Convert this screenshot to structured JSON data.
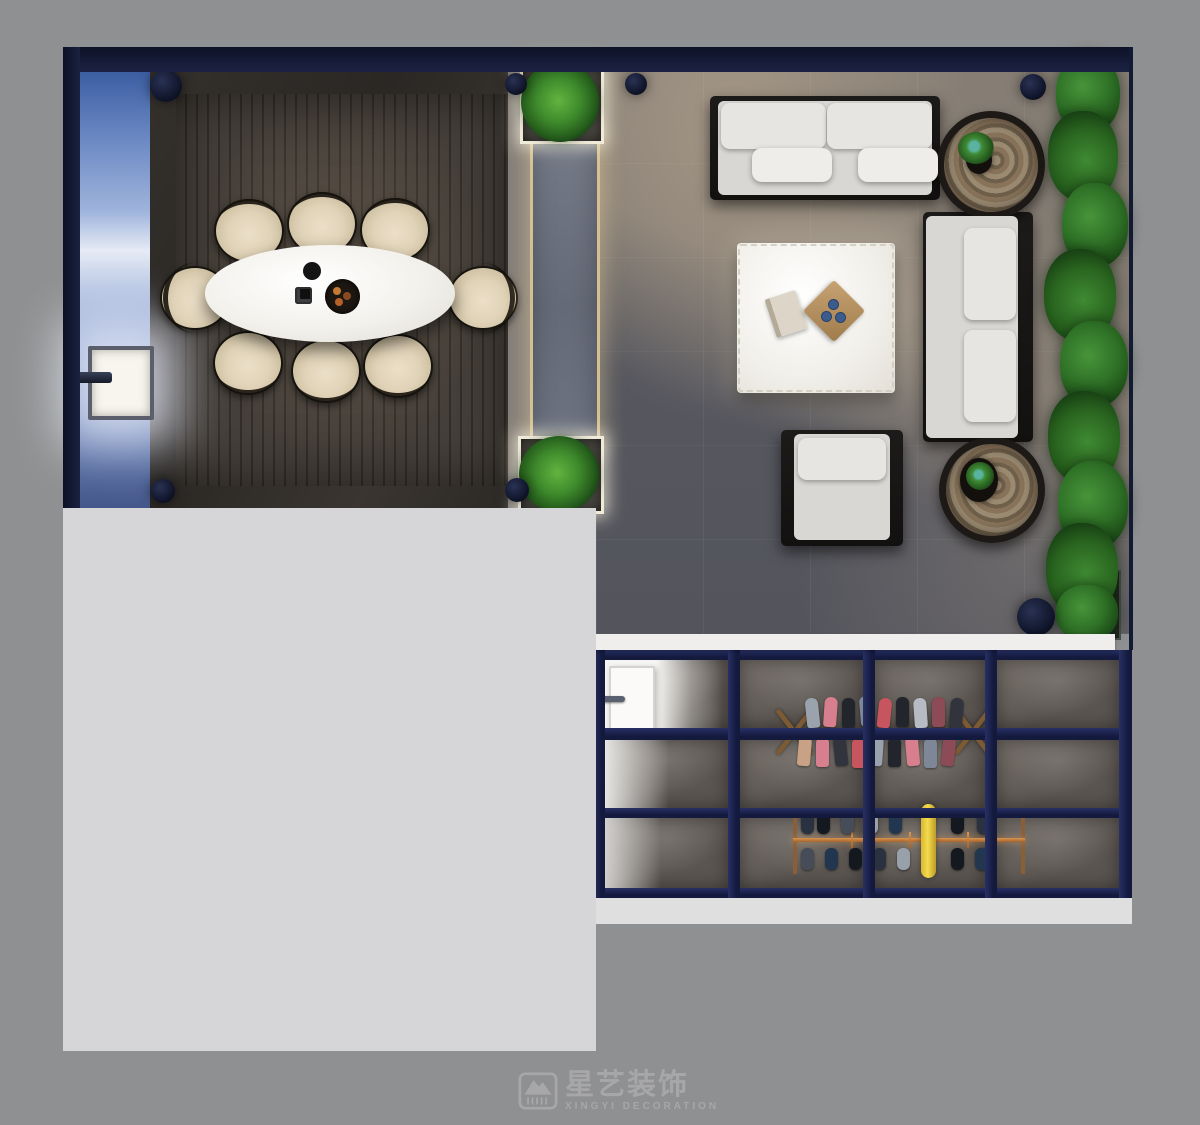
{
  "watermark": {
    "logo_icon": "xingyi-house-logo-icon",
    "brand_cn": "星艺装饰",
    "brand_en": "XINGYI DECORATION"
  },
  "palette": {
    "canvas_background": "#8f9091",
    "masked_region_gray": "#d6d6d8",
    "wall_navy": "#141a33",
    "partition_frame_navy": "#1a2150",
    "pool_blue": "#7b92c4",
    "deck_wood_brown": "#3d3833",
    "living_floor_gray": "#80786f",
    "cool_floor_shadow": "#2f384e",
    "cushion_white": "#d9d7d3",
    "table_white": "#f3f1ec",
    "chair_beige": "#d9cbae",
    "plant_green": "#2f7227",
    "copper_rail": "#c0803f",
    "led_glow_warm": "#e9ce96",
    "ledge_white": "#efeeec"
  },
  "scene": {
    "view": "top-down-interior-render",
    "areas": [
      {
        "name": "pool-strip",
        "items": [
          "wall-niche-light",
          "spout-fixture"
        ]
      },
      {
        "name": "dining-deck",
        "items": [
          "oval-dining-table",
          "decor-cup",
          "decor-plate",
          "decor-bowl"
        ],
        "chairs": 8
      },
      {
        "name": "walkway",
        "items": [
          "led-path",
          "planter-top",
          "planter-bottom"
        ]
      },
      {
        "name": "living-room",
        "items": [
          "sofa-top",
          "sofa-right",
          "armchair",
          "coffee-table",
          "book",
          "decor-tray",
          "side-table-top",
          "side-table-bottom",
          "hedge",
          "hedge-planter"
        ]
      },
      {
        "name": "glass-partition-room",
        "items": [
          "white-door",
          "clothes-rack",
          "shoe-rack",
          "yellow-umbrella"
        ],
        "grid": {
          "columns": 4,
          "rows": 3
        }
      }
    ],
    "pillar_dots": 6
  }
}
